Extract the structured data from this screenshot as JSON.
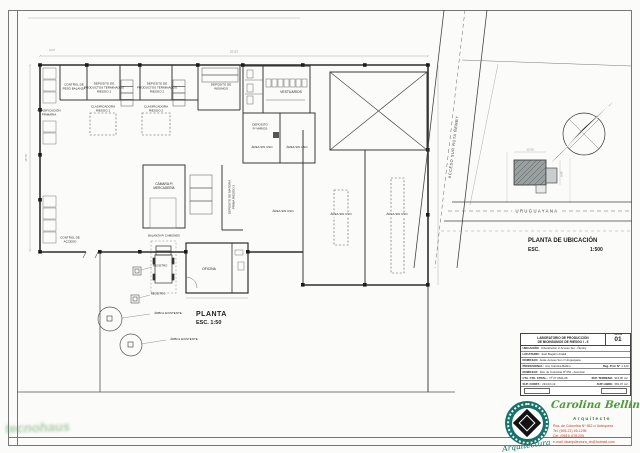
{
  "floor_plan": {
    "title": "PLANTA",
    "scale": "ESC. 1:50",
    "rooms": {
      "control_peso": "CONTROL DE\nPESO BALANZA",
      "dep_term_1": "DEPOSITO DE\nPRODUCTOS TERMINADOS\nRIESGO 1",
      "dep_term_2": "DEPOSITO DE\nPRODUCTOS TERMINADOS\nRIESGO 2",
      "clasificadora_1": "CLASIFICADORA\nRIESGO 1",
      "clasificadora_2": "CLASIFICADORA\nRIESGO 2",
      "dep_insumos": "DEPOSITO DE\nINSUMOS",
      "clasificacion_primaria": "CLASIFICACIÓN\nPRIMARIA",
      "camara": "CÁMARA P/\nMERCADERÍA",
      "dep_materia_prima": "DEPOSITO DE MATERIA\nPRIMA RIESGO 3",
      "vestuarios": "VESTUARIOS",
      "dep_varios": "DEPOSITO\nP/ VARIOS",
      "area_sin_uso": "ÁREA SIN USO",
      "oficina": "OFICINA",
      "control_acceso": "CONTROL DE\nACCESO"
    },
    "annotations": {
      "balanza": "BALANZA P/ CAMIONES",
      "arbol": "ÁRBOL EXISTENTE",
      "registro": "REGISTRO"
    },
    "dims": {
      "top": "27,07",
      "top_left": "2,07",
      "left": "18,70"
    }
  },
  "site_plan": {
    "title": "PLANTA DE UBICACIÓN",
    "scale_label": "ESC.",
    "scale_value": "1:500",
    "road_name": "ACCESO SUR  RUTA  ÑEMBY",
    "street_name": "URUGUAYANA",
    "dims": {
      "width": "12,05",
      "depth": "8,45"
    }
  },
  "title_block": {
    "project_line1": "LABORATORIO DE PRODUCCIÓN",
    "project_line2": "DE BIOINSUMOS DE RIESGO I - II",
    "sheet_label": "LÁMINA",
    "sheet_number": "01",
    "rows": [
      {
        "label": "UBICACIÓN:",
        "value": "Urbanización c/ Acceso Sur - Ñemby"
      },
      {
        "label": "LOCATARIO:",
        "value": "Juan Bogarín Airaldi"
      },
      {
        "label": "DOMICILIO:",
        "value": "Avda. Acceso Sur c/ Uruguayana"
      },
      {
        "label": "PROFESIONAL:",
        "value": "Arq. Carolina Bellino",
        "label2": "Reg. Prof. Nº",
        "value2": "2.120"
      },
      {
        "label": "DOMICILIO:",
        "value": "Rca. de Colombia Nº 652 - Asunción"
      },
      {
        "label": "CTA. CTE. CTRAL.:",
        "value": "Nº 27-0631-05",
        "label2": "SUP. TERRENO:",
        "value2": "916,00 m2."
      },
      {
        "label": "SUP. CONST.:",
        "value": "234,03 m2.",
        "label2": "SUP. LIBRE:",
        "value2": "681,97 m2."
      }
    ]
  },
  "architect": {
    "name": "Carolina Bellino",
    "title": "Arquitecto",
    "address": "Rca. de Colombia Nº 652 c/ Antequera",
    "phone": "Tel. (595-21) 45-1295",
    "cell": "Cel. (0981) 678.205",
    "email": "e-mail: bkarquitectura_cb@hotmail.com",
    "seal_text": "Arquitectura",
    "accent_teal": "#17726a",
    "accent_green": "#4e9a3c",
    "accent_red": "#c43c2b"
  },
  "watermark": {
    "text": "tecnohaus"
  }
}
